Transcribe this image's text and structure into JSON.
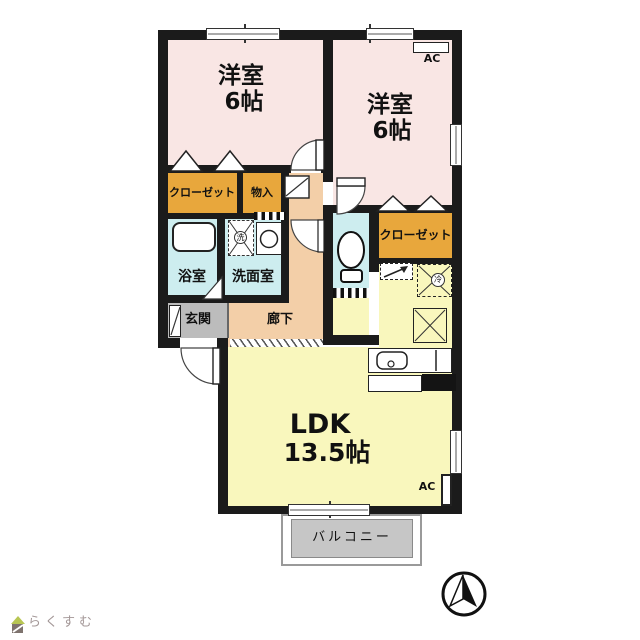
{
  "floorplan": {
    "rooms": {
      "bedroom1": {
        "name": "洋室",
        "size": "6帖"
      },
      "bedroom2": {
        "name": "洋室",
        "size": "6帖"
      },
      "ldk": {
        "name": "LDK",
        "size": "13.5帖"
      },
      "bathroom": {
        "label": "浴室"
      },
      "washroom": {
        "label": "洗面室"
      },
      "entrance": {
        "label": "玄関"
      },
      "hallway": {
        "label": "廊下"
      },
      "closet1": {
        "label": "クローゼット"
      },
      "closet2": {
        "label": "クローゼット"
      },
      "storage": {
        "label": "物入"
      },
      "balcony": {
        "label": "バルコニー"
      }
    },
    "equipment": {
      "ac_bedroom2": {
        "label": "AC"
      },
      "ac_ldk": {
        "label": "AC"
      },
      "washer_mark": "洗",
      "fridge_mark": "冷"
    },
    "colors": {
      "wall": "#1b1b1b",
      "bedroom": "#f9e6e4",
      "closet": "#e8a73c",
      "water": "#cdedef",
      "hallway": "#f3cfa8",
      "entrance": "#bcbcbc",
      "ldk": "#f9f7bd",
      "balcony": "#c6c6c6"
    }
  },
  "branding": {
    "logo_text": "らくすむ"
  }
}
